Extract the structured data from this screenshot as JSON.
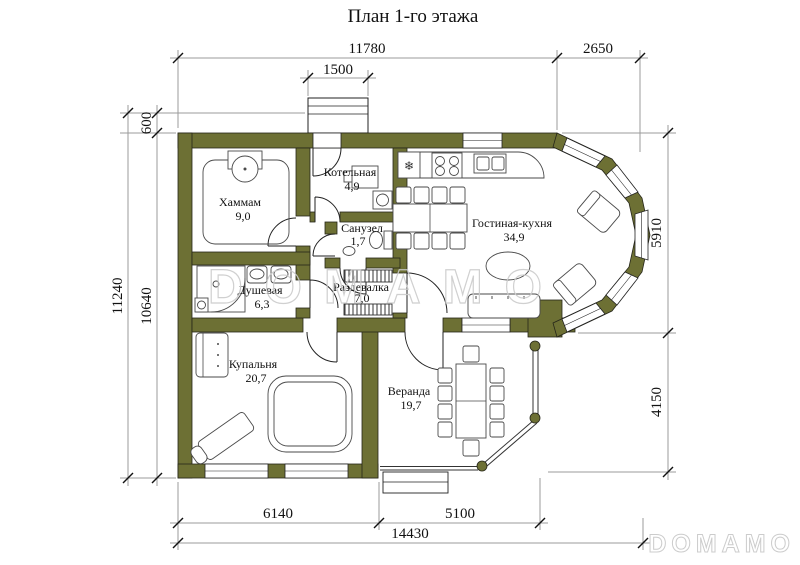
{
  "title": "План 1-го этажа",
  "watermark": {
    "center": "DOMAMO",
    "corner": "DOMAMO"
  },
  "icons": {
    "snowflake": "❄"
  },
  "colors": {
    "wall": "#6d7034",
    "dim": "#9b9b9b",
    "watermark": "#cccccc"
  },
  "dimensions": {
    "top": [
      "11780",
      "2650",
      "1500"
    ],
    "left": [
      "600",
      "11240",
      "10640"
    ],
    "right": [
      "5910",
      "4150"
    ],
    "bottom": [
      "6140",
      "5100",
      "14430"
    ]
  },
  "rooms": [
    {
      "name": "Хаммам",
      "area": "9,0"
    },
    {
      "name": "Котельная",
      "area": "4,9"
    },
    {
      "name": "Санузел",
      "area": "1,7"
    },
    {
      "name": "Душевая",
      "area": "6,3"
    },
    {
      "name": "Раздевалка",
      "area": "7,0"
    },
    {
      "name": "Гостиная-кухня",
      "area": "34,9"
    },
    {
      "name": "Купальня",
      "area": "20,7"
    },
    {
      "name": "Веранда",
      "area": "19,7"
    }
  ]
}
